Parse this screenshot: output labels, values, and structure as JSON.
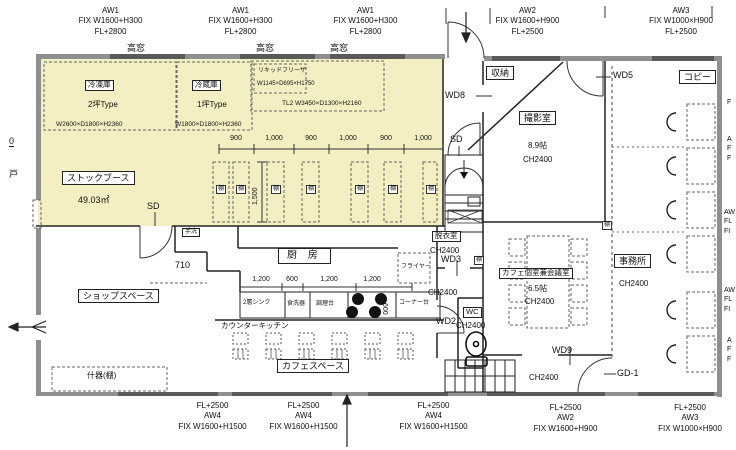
{
  "plan": {
    "colors": {
      "highlight": "#f4efc3",
      "wall": "#8f8f8f",
      "window": "#5a5a5a",
      "line": "#222222"
    },
    "tana": "棚",
    "ch": "CH2400",
    "top_windows": [
      {
        "id": "AW1",
        "spec": "FIX W1600+H300",
        "fl": "FL+2800",
        "tag": "高窓"
      },
      {
        "id": "AW1",
        "spec": "FIX W1600+H300",
        "fl": "FL+2800",
        "tag": "高窓"
      },
      {
        "id": "AW1",
        "spec": "FIX W1600+H300",
        "fl": "FL+2800",
        "tag": "高窓"
      },
      {
        "id": "AW2",
        "spec": "FIX W1600+H900",
        "fl": "FL+2500"
      },
      {
        "id": "AW3",
        "spec": "FIX W1000×H900",
        "fl": "FL+2500"
      }
    ],
    "bottom_windows": [
      {
        "fl": "FL+2500",
        "id": "AW4",
        "spec": "FIX W1600+H1500"
      },
      {
        "fl": "FL+2500",
        "id": "AW4",
        "spec": "FIX W1600+H1500"
      },
      {
        "fl": "FL+2500",
        "id": "AW4",
        "spec": "FIX W1600+H1500"
      },
      {
        "fl": "FL+2500",
        "id": "AW2",
        "spec": "FIX W1600+H900"
      },
      {
        "fl": "FL+2500",
        "id": "AW3",
        "spec": "FIX W1000×H900"
      }
    ],
    "stock": {
      "label": "ストックブース",
      "area": "49.03㎡"
    },
    "freezer": {
      "label": "冷凍庫",
      "type": "2坪Type",
      "size": "W2600×D1800×H2360"
    },
    "fridge": {
      "label": "冷蔵庫",
      "type": "1坪Type",
      "size": "W1800×D1800×H2360"
    },
    "liquid": {
      "label": "リキッドフリーザ",
      "size": "W1145×D695×H1750"
    },
    "tl2": "TL2  W3450×D1300×H2160",
    "rack_dims": [
      "900",
      "1,000",
      "900",
      "1,000",
      "900",
      "1,000"
    ],
    "rack_vdim": "1,500",
    "kitchen": {
      "label": "厨  房",
      "dims": [
        "1,200",
        "600",
        "1,200",
        "1,200"
      ],
      "vdim": "600",
      "corridor": "710",
      "sink": "2層シンク",
      "dishwasher": "食洗器",
      "prep": "調理台",
      "corner": "コーナー台",
      "fryer": "フライヤー",
      "counter": "カウンターキッチン",
      "handwash": "手洗"
    },
    "shop": "ショップスペース",
    "cafe": "カフェスペース",
    "fixture": "什器(棚)",
    "photo": {
      "label": "撮影室",
      "size": "8.9帖"
    },
    "office": {
      "label": "事務所"
    },
    "storage": "収納",
    "copy": "コピー",
    "dressing": {
      "label": "脱衣室"
    },
    "wc": "WC",
    "caferoom": {
      "label": "カフェ個室兼会議室",
      "size": "6.5帖"
    },
    "doors": {
      "sd": "SD",
      "wd8": "WD8",
      "wd5": "WD5",
      "wd3": "WD3",
      "wd2": "WD2",
      "wd9": "WD9",
      "gd1": "GD-1",
      "left": "戸"
    },
    "edge": {
      "zero": "0",
      "r1": "F",
      "r2": "A\nF\nF",
      "r3": "AW\nFL\nFI",
      "r4": "AW\nFL\nFI",
      "r5": "A\nF\nF"
    }
  }
}
